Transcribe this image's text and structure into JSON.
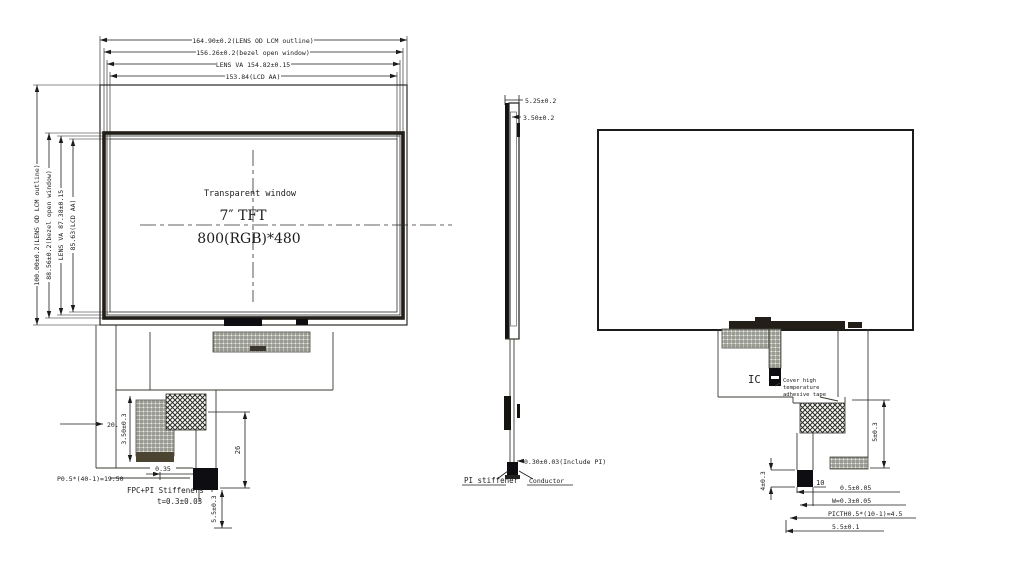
{
  "front": {
    "dims_top": [
      "164.90±0.2(LENS OD LCM outline)",
      "156.26±0.2(bezel open window)",
      "LENS VA 154.82±0.15",
      "153.84(LCD AA)"
    ],
    "dims_left": [
      "100.00±0.2(LENS OD LCM outline)",
      "88.56±0.2(bezel open window)",
      "LENS VA 87.38±0.15",
      "85.63(LCD AA)"
    ],
    "window_label": "Transparent window",
    "size_label": "7″ TFT",
    "resolution_label": "800(RGB)*480",
    "dim_2047": "20.47",
    "dim_350": "3.50±0.3",
    "dim_035": "0.35",
    "pin_pitch": "P0.5*(40-1)=19.50",
    "stiffener_line1": "FPC+PI Stiffeners",
    "stiffener_line2": "t=0.3±0.03",
    "dim_5_5": "5.5±0.3",
    "dim_26": "26"
  },
  "side": {
    "dim_total": "5.25±0.2",
    "dim_module": "3.50±0.2",
    "dim_fpc": "0.30±0.03(Include PI)",
    "pi_stiffener": "PI stiffener",
    "conductor": "Conductor"
  },
  "back": {
    "ic": "IC",
    "tape_note": [
      "Cover high",
      "temperature",
      "adhesive tape"
    ],
    "dim_5": "5±0.3",
    "dim_4": "4±0.3",
    "pin_count": "10",
    "dim_0_5": "0.5±0.05",
    "dim_w": "W=0.3±0.05",
    "dim_pitch": "PICTH0.5*(10-1)=4.5",
    "dim_5_5": "5.5±0.1"
  },
  "colors": {
    "line": "#1c1c1c",
    "background": "#ffffff"
  }
}
